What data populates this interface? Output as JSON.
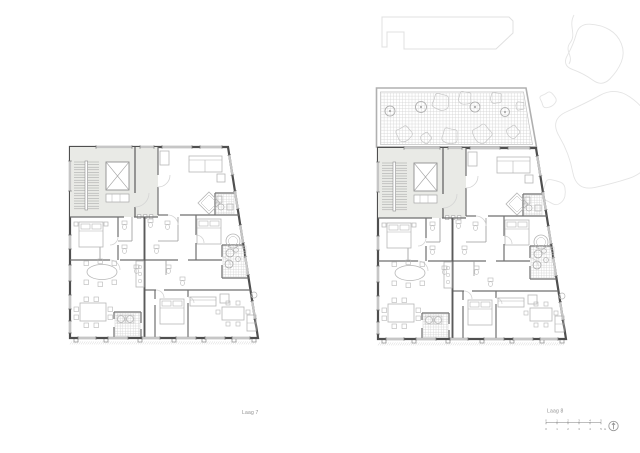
{
  "document_title": "Floor plan sheet",
  "plans": [
    {
      "id": "laag-7",
      "label": "Laag 7",
      "features": {
        "roof_terrace": false,
        "neighbor_building": false,
        "vegetation": false
      }
    },
    {
      "id": "laag-8",
      "label": "Laag 8",
      "features": {
        "roof_terrace": true,
        "neighbor_building": true,
        "vegetation": true
      }
    }
  ],
  "scalebar": {
    "marks": [
      "0",
      "1",
      "2",
      "3",
      "4",
      "5"
    ],
    "unit": "m"
  },
  "north_arrow": {
    "name": "north-arrow"
  },
  "colors": {
    "background": "#ffffff",
    "wall": "#4f4f4f",
    "interior_wall": "#6f6f6f",
    "party_wall": "#5a5a5a",
    "light_partition": "#9a9a9a",
    "furniture": "#b6b6b6",
    "core_fill": "#e9eae6",
    "core_line": "#a0a0a0",
    "tile": "#d2d2d2",
    "window": "#c6c6c6",
    "door_arc": "#d4d4d4",
    "context": "#e0e0e0",
    "vegetation": "#e4e4e4",
    "terrace_rail": "#b0b0b0",
    "plant": "#c6c6c6",
    "hatch": "#d4d4d4",
    "label_text": "#8f8f8f",
    "scale_text": "#7c7c7c"
  }
}
